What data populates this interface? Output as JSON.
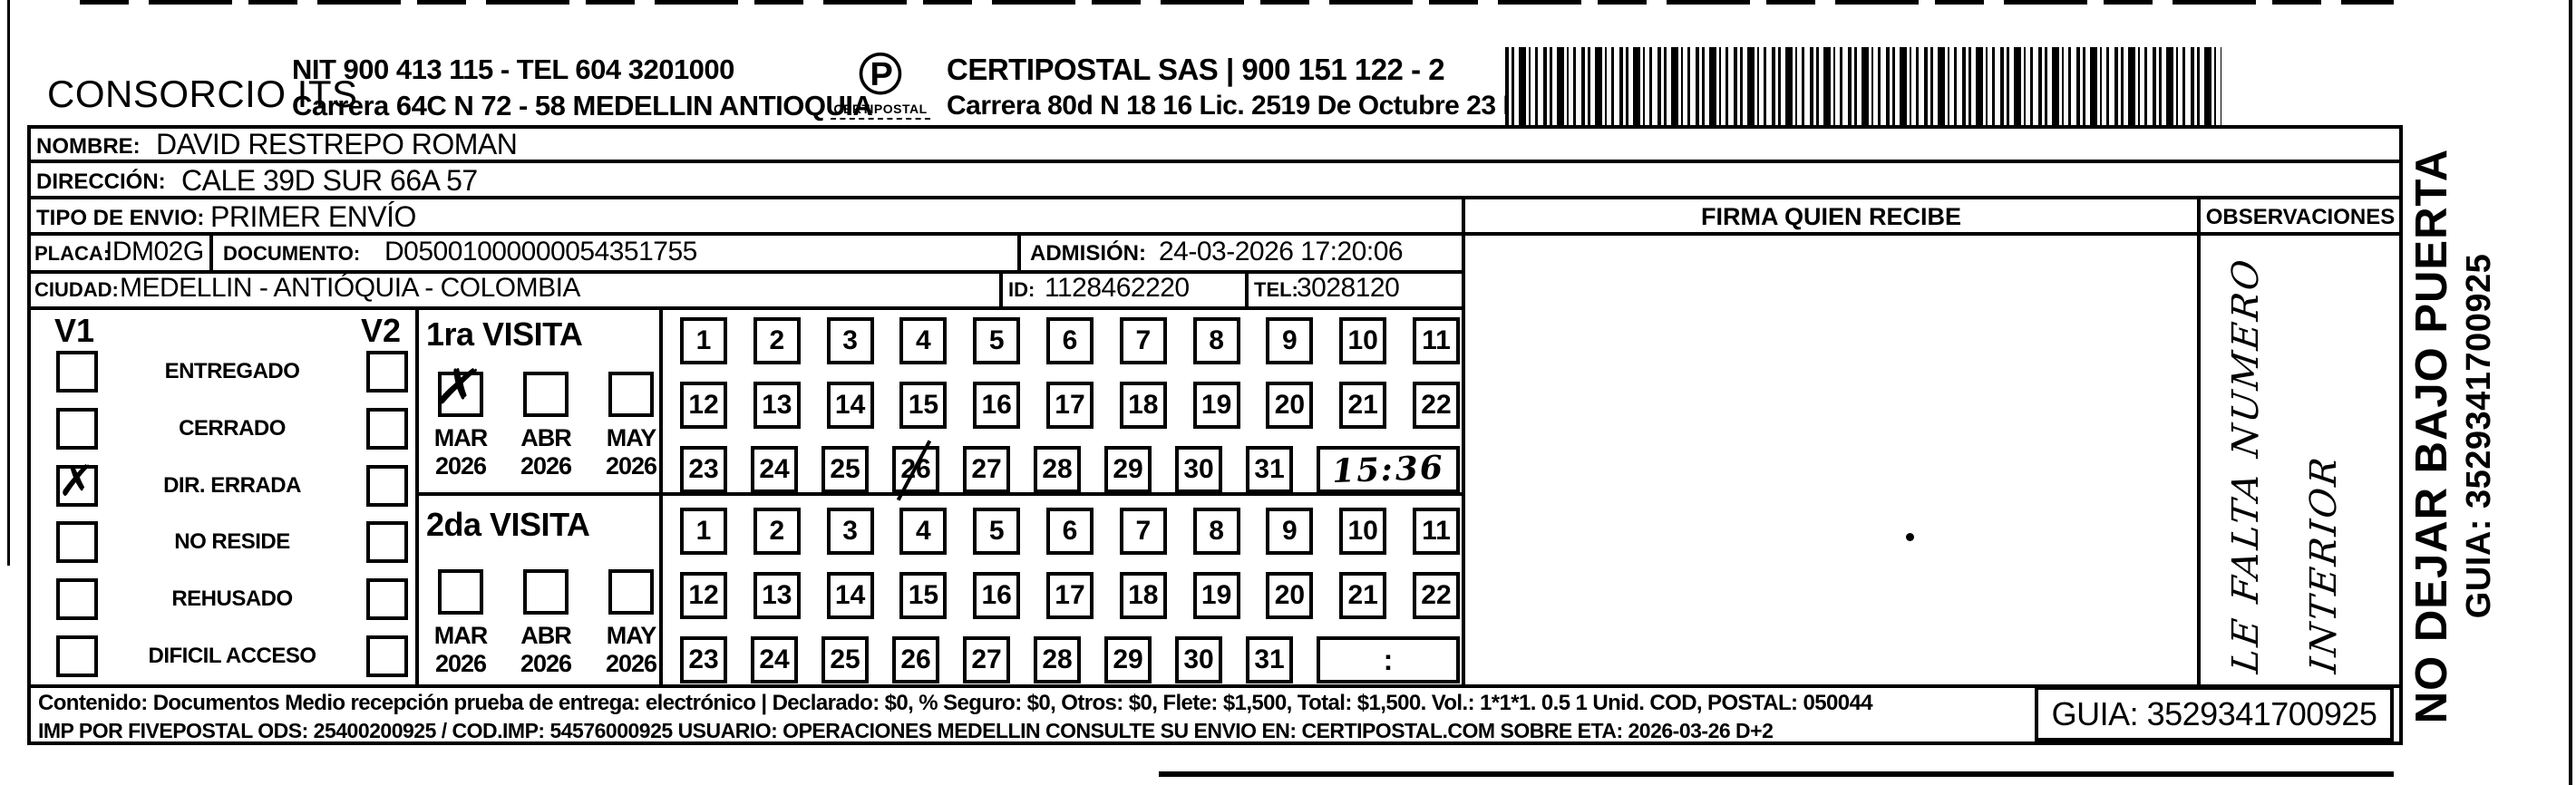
{
  "header": {
    "company": "CONSORCIO ITS",
    "nit_line": "NIT 900 413 115 - TEL 604 3201000",
    "address_line": "Carrera 64C N 72 - 58 MEDELLIN ANTIOQUIA",
    "logo_caption": "CERTIPOSTAL",
    "certipostal_line1": "CERTIPOSTAL SAS | 900 151 122 - 2",
    "certipostal_line2": "Carrera 80d N 18 16  Lic. 2519 De Octubre 23 De 2015"
  },
  "rows": {
    "nombre_label": "NOMBRE:",
    "nombre": "DAVID RESTREPO ROMAN",
    "direccion_label": "DIRECCIÓN:",
    "direccion": "CALE 39D SUR 66A 57",
    "tipo_label": "TIPO DE ENVIO:",
    "tipo": "PRIMER ENVÍO",
    "placa_label": "PLACA:",
    "placa": "IDM02G",
    "documento_label": "DOCUMENTO:",
    "documento": "D05001000000054351755",
    "admision_label": "ADMISIÓN:",
    "admision": "24-03-2026 17:20:06",
    "ciudad_label": "CIUDAD:",
    "ciudad": "MEDELLIN - ANTIÓQUIA - COLOMBIA",
    "id_label": "ID:",
    "id": "1128462220",
    "tel_label": "TEL:",
    "tel": "3028120"
  },
  "columns": {
    "firma": "FIRMA QUIEN RECIBE",
    "observaciones": "OBSERVACIONES"
  },
  "status": {
    "v1_header": "V1",
    "v2_header": "V2",
    "items": [
      {
        "label": "ENTREGADO",
        "v1": false,
        "v2": false
      },
      {
        "label": "CERRADO",
        "v1": false,
        "v2": false
      },
      {
        "label": "DIR. ERRADA",
        "v1": true,
        "v2": false
      },
      {
        "label": "NO RESIDE",
        "v1": false,
        "v2": false
      },
      {
        "label": "REHUSADO",
        "v1": false,
        "v2": false
      },
      {
        "label": "DIFICIL ACCESO",
        "v1": false,
        "v2": false
      }
    ],
    "check_glyph": "✗"
  },
  "visits": [
    {
      "title": "1ra VISITA",
      "months": [
        {
          "label": "MAR",
          "year": "2026",
          "checked": true
        },
        {
          "label": "ABR",
          "year": "2026",
          "checked": false
        },
        {
          "label": "MAY",
          "year": "2026",
          "checked": false
        }
      ],
      "day_rows": [
        [
          1,
          2,
          3,
          4,
          5,
          6,
          7,
          8,
          9,
          10,
          11
        ],
        [
          12,
          13,
          14,
          15,
          16,
          17,
          18,
          19,
          20,
          21,
          22
        ],
        [
          23,
          24,
          25,
          26,
          27,
          28,
          29,
          30,
          31
        ]
      ],
      "marked_day": 26,
      "time": "15:36",
      "time_handwritten": true
    },
    {
      "title": "2da VISITA",
      "months": [
        {
          "label": "MAR",
          "year": "2026",
          "checked": false
        },
        {
          "label": "ABR",
          "year": "2026",
          "checked": false
        },
        {
          "label": "MAY",
          "year": "2026",
          "checked": false
        }
      ],
      "day_rows": [
        [
          1,
          2,
          3,
          4,
          5,
          6,
          7,
          8,
          9,
          10,
          11
        ],
        [
          12,
          13,
          14,
          15,
          16,
          17,
          18,
          19,
          20,
          21,
          22
        ],
        [
          23,
          24,
          25,
          26,
          27,
          28,
          29,
          30,
          31
        ]
      ],
      "marked_day": null,
      "time": ":",
      "time_handwritten": false
    }
  ],
  "observations_note": {
    "line1": "LE FALTA NUMERO",
    "line2": "INTERIOR"
  },
  "side": {
    "warning": "NO DEJAR BAJO PUERTA",
    "guia": "GUIA: 3529341700925"
  },
  "footer": {
    "line1": "Contenido: Documentos Medio recepción prueba de entrega: electrónico | Declarado: $0, % Seguro: $0, Otros: $0, Flete: $1,500, Total: $1,500. Vol.: 1*1*1. 0.5  1 Unid. COD, POSTAL: 050044",
    "line2": "IMP POR FIVEPOSTAL ODS: 25400200925 / COD.IMP: 54576000925 USUARIO: OPERACIONES MEDELLIN CONSULTE SU ENVIO EN: CERTIPOSTAL.COM SOBRE ETA: 2026-03-26 D+2",
    "guia": "GUIA: 3529341700925"
  },
  "colors": {
    "ink": "#000000",
    "paper": "#ffffff"
  }
}
